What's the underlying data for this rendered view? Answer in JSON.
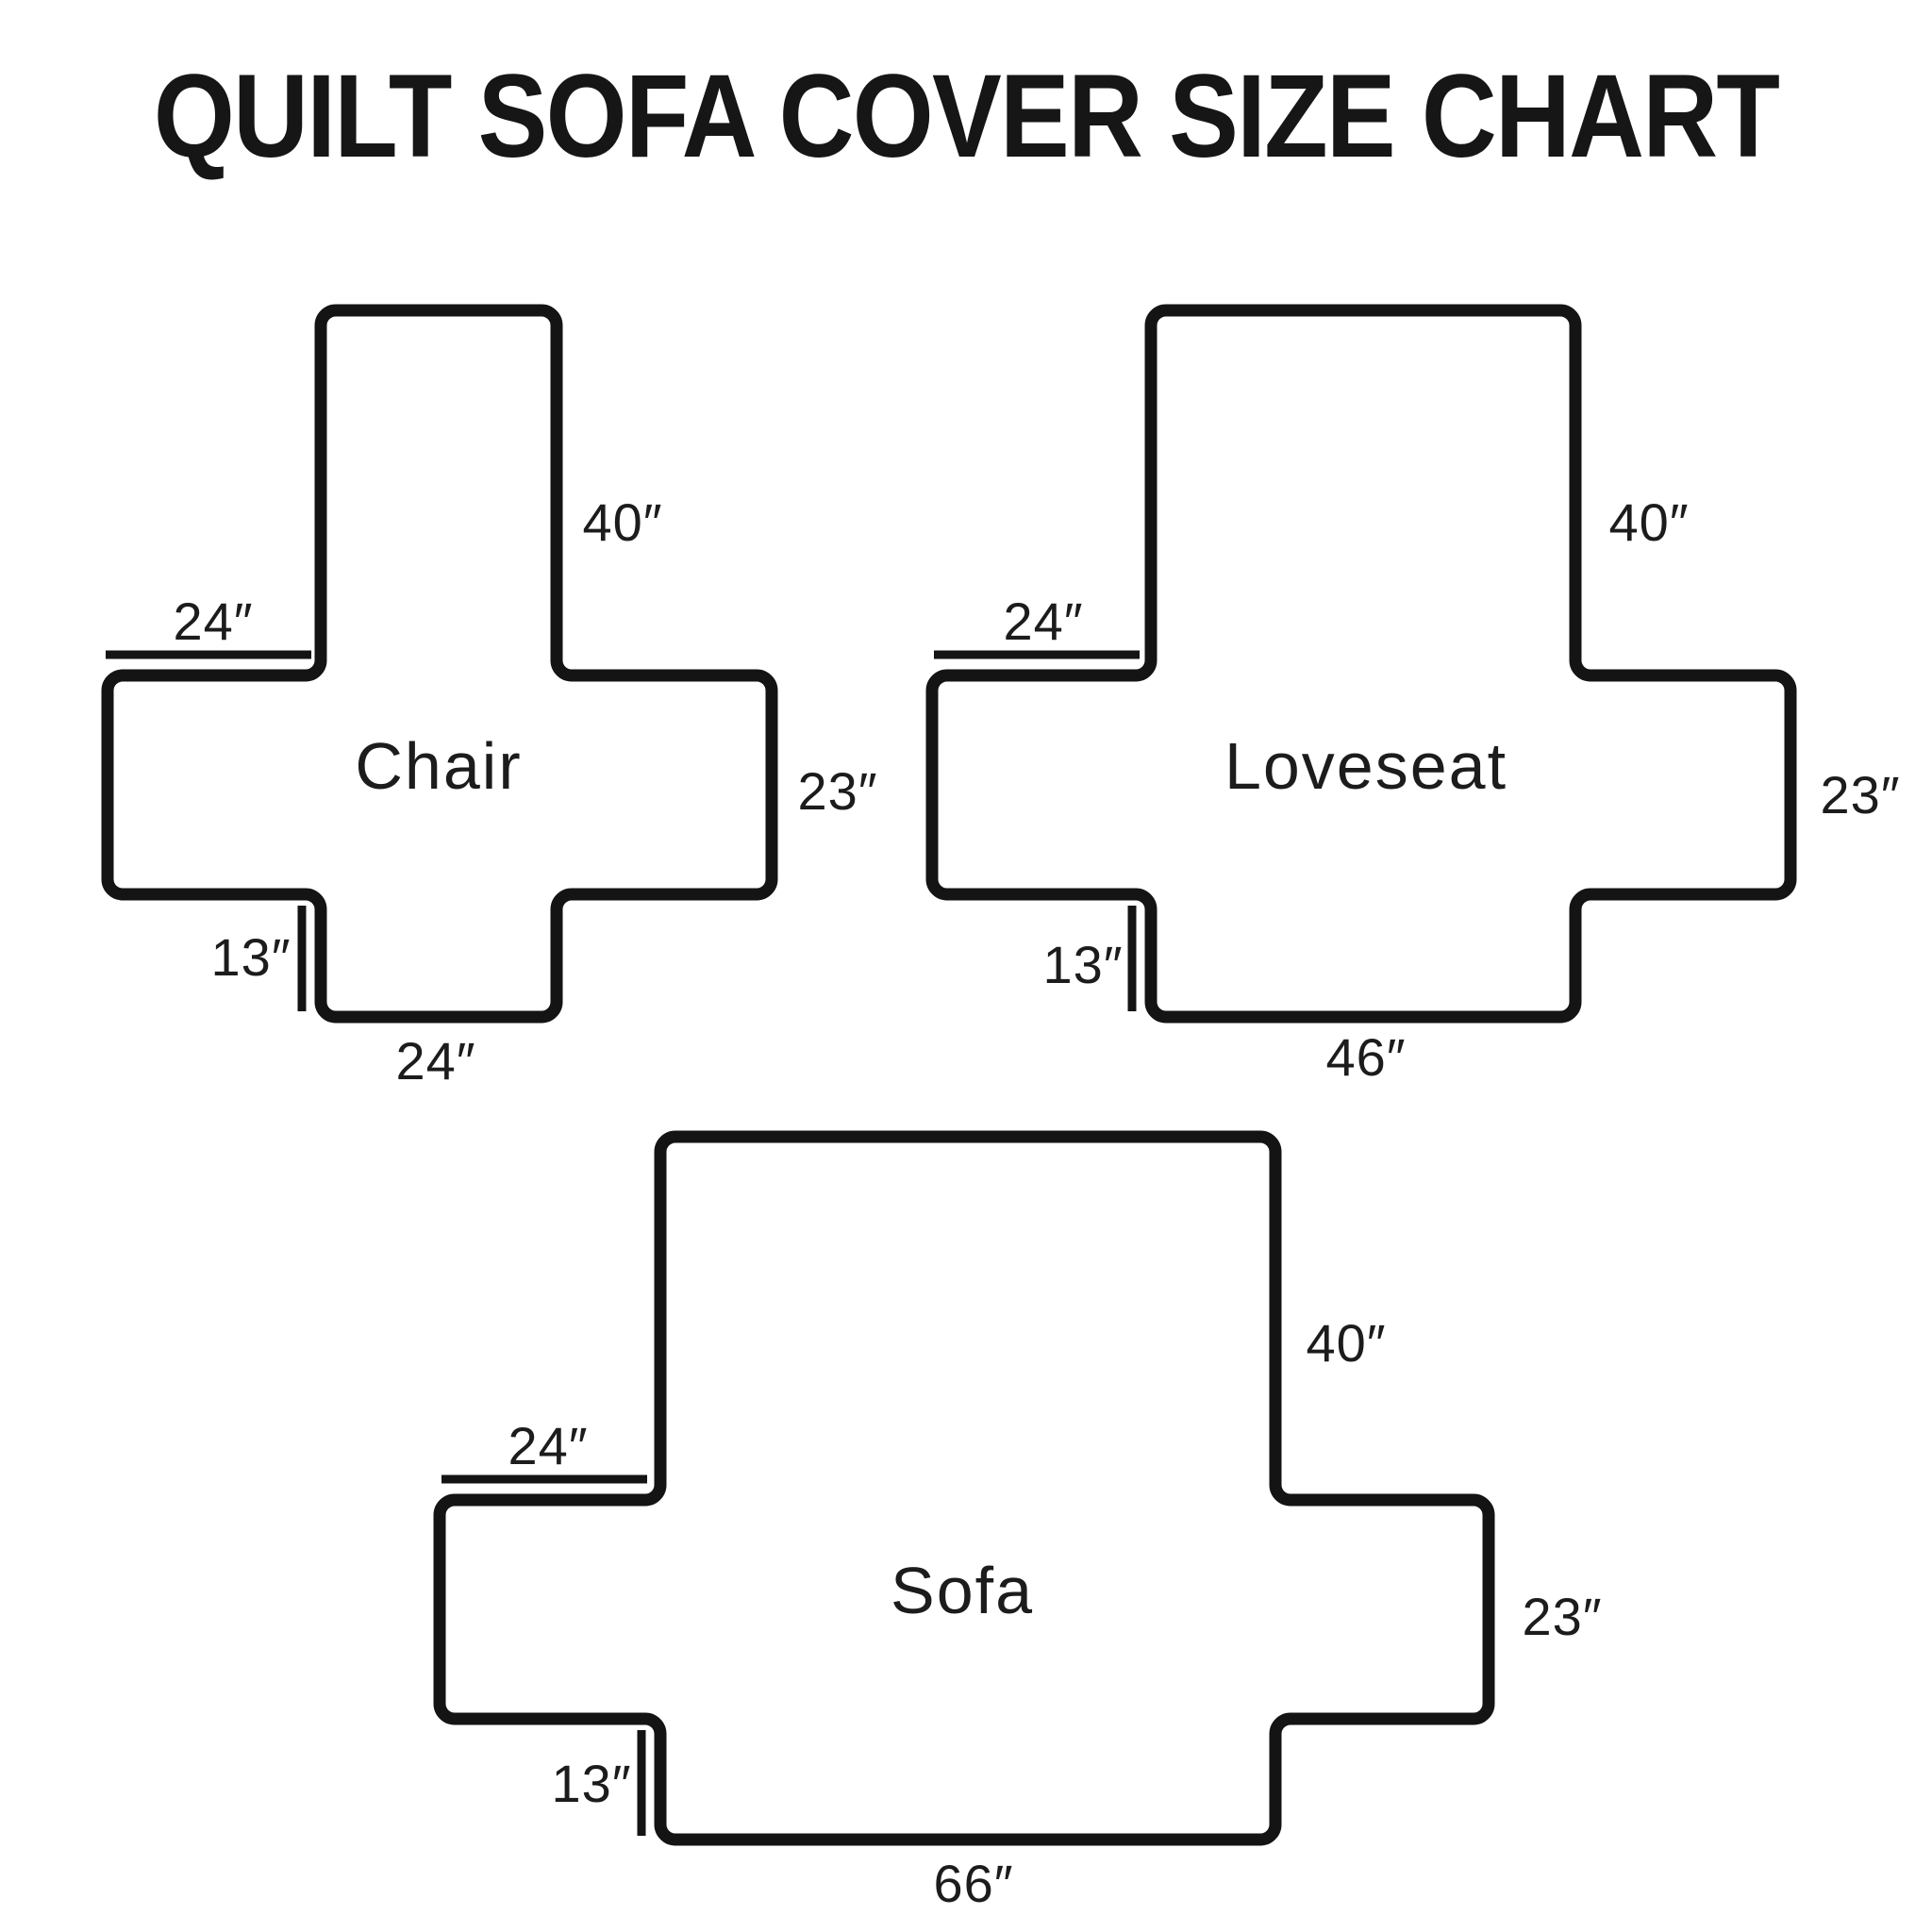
{
  "title": "QUILT SOFA COVER SIZE CHART",
  "colors": {
    "background": "#ffffff",
    "line": "#141414",
    "text": "#1c1c1c"
  },
  "diagrams": [
    {
      "name": "Chair",
      "dimensions": {
        "back_length": "40″",
        "arm_top_width": "24″",
        "side_height": "23″",
        "front_flap_drop": "13″",
        "front_width": "24″"
      }
    },
    {
      "name": "Loveseat",
      "dimensions": {
        "back_length": "40″",
        "arm_top_width": "24″",
        "side_height": "23″",
        "front_flap_drop": "13″",
        "front_width": "46″"
      }
    },
    {
      "name": "Sofa",
      "dimensions": {
        "back_length": "40″",
        "arm_top_width": "24″",
        "side_height": "23″",
        "front_flap_drop": "13″",
        "front_width": "66″"
      }
    }
  ]
}
